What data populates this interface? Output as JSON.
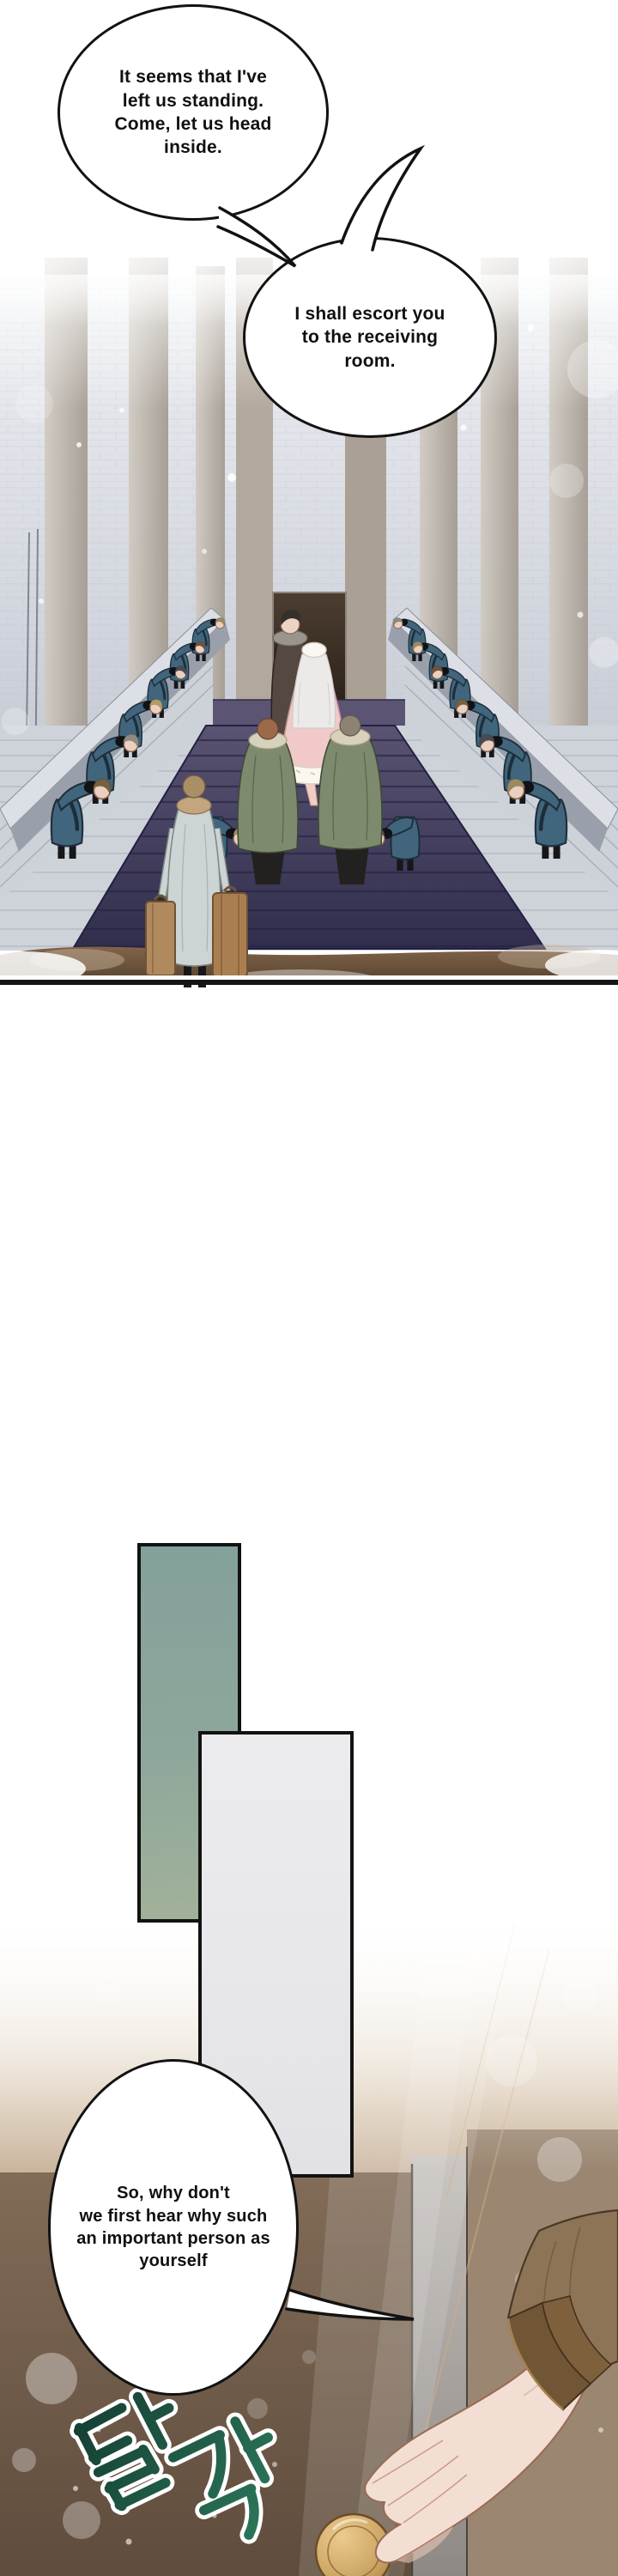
{
  "dialogue": {
    "bubble1": "It seems that I've\nleft us standing.\nCome, let us head\ninside.",
    "bubble2": "I shall escort you\nto the receiving\nroom.",
    "bubble3": "So, why don't\nwe first hear why such\nan important person as\nyourself"
  },
  "sfx": {
    "text": "달각"
  },
  "colors": {
    "panel_teal": "#8ca39b",
    "panel_gray": "#e9e9ec",
    "carpet_navy": "#3b3757",
    "servant_coat": "#41657c",
    "gown_pink": "#f1c9c9",
    "cloak_green": "#7d8a6e",
    "suitcase_brown": "#b08a5e",
    "door_brown": "#6d5947",
    "knob_gold": "#c9a25f",
    "sfx_green": "#1e5c49",
    "outline": "#141414"
  }
}
